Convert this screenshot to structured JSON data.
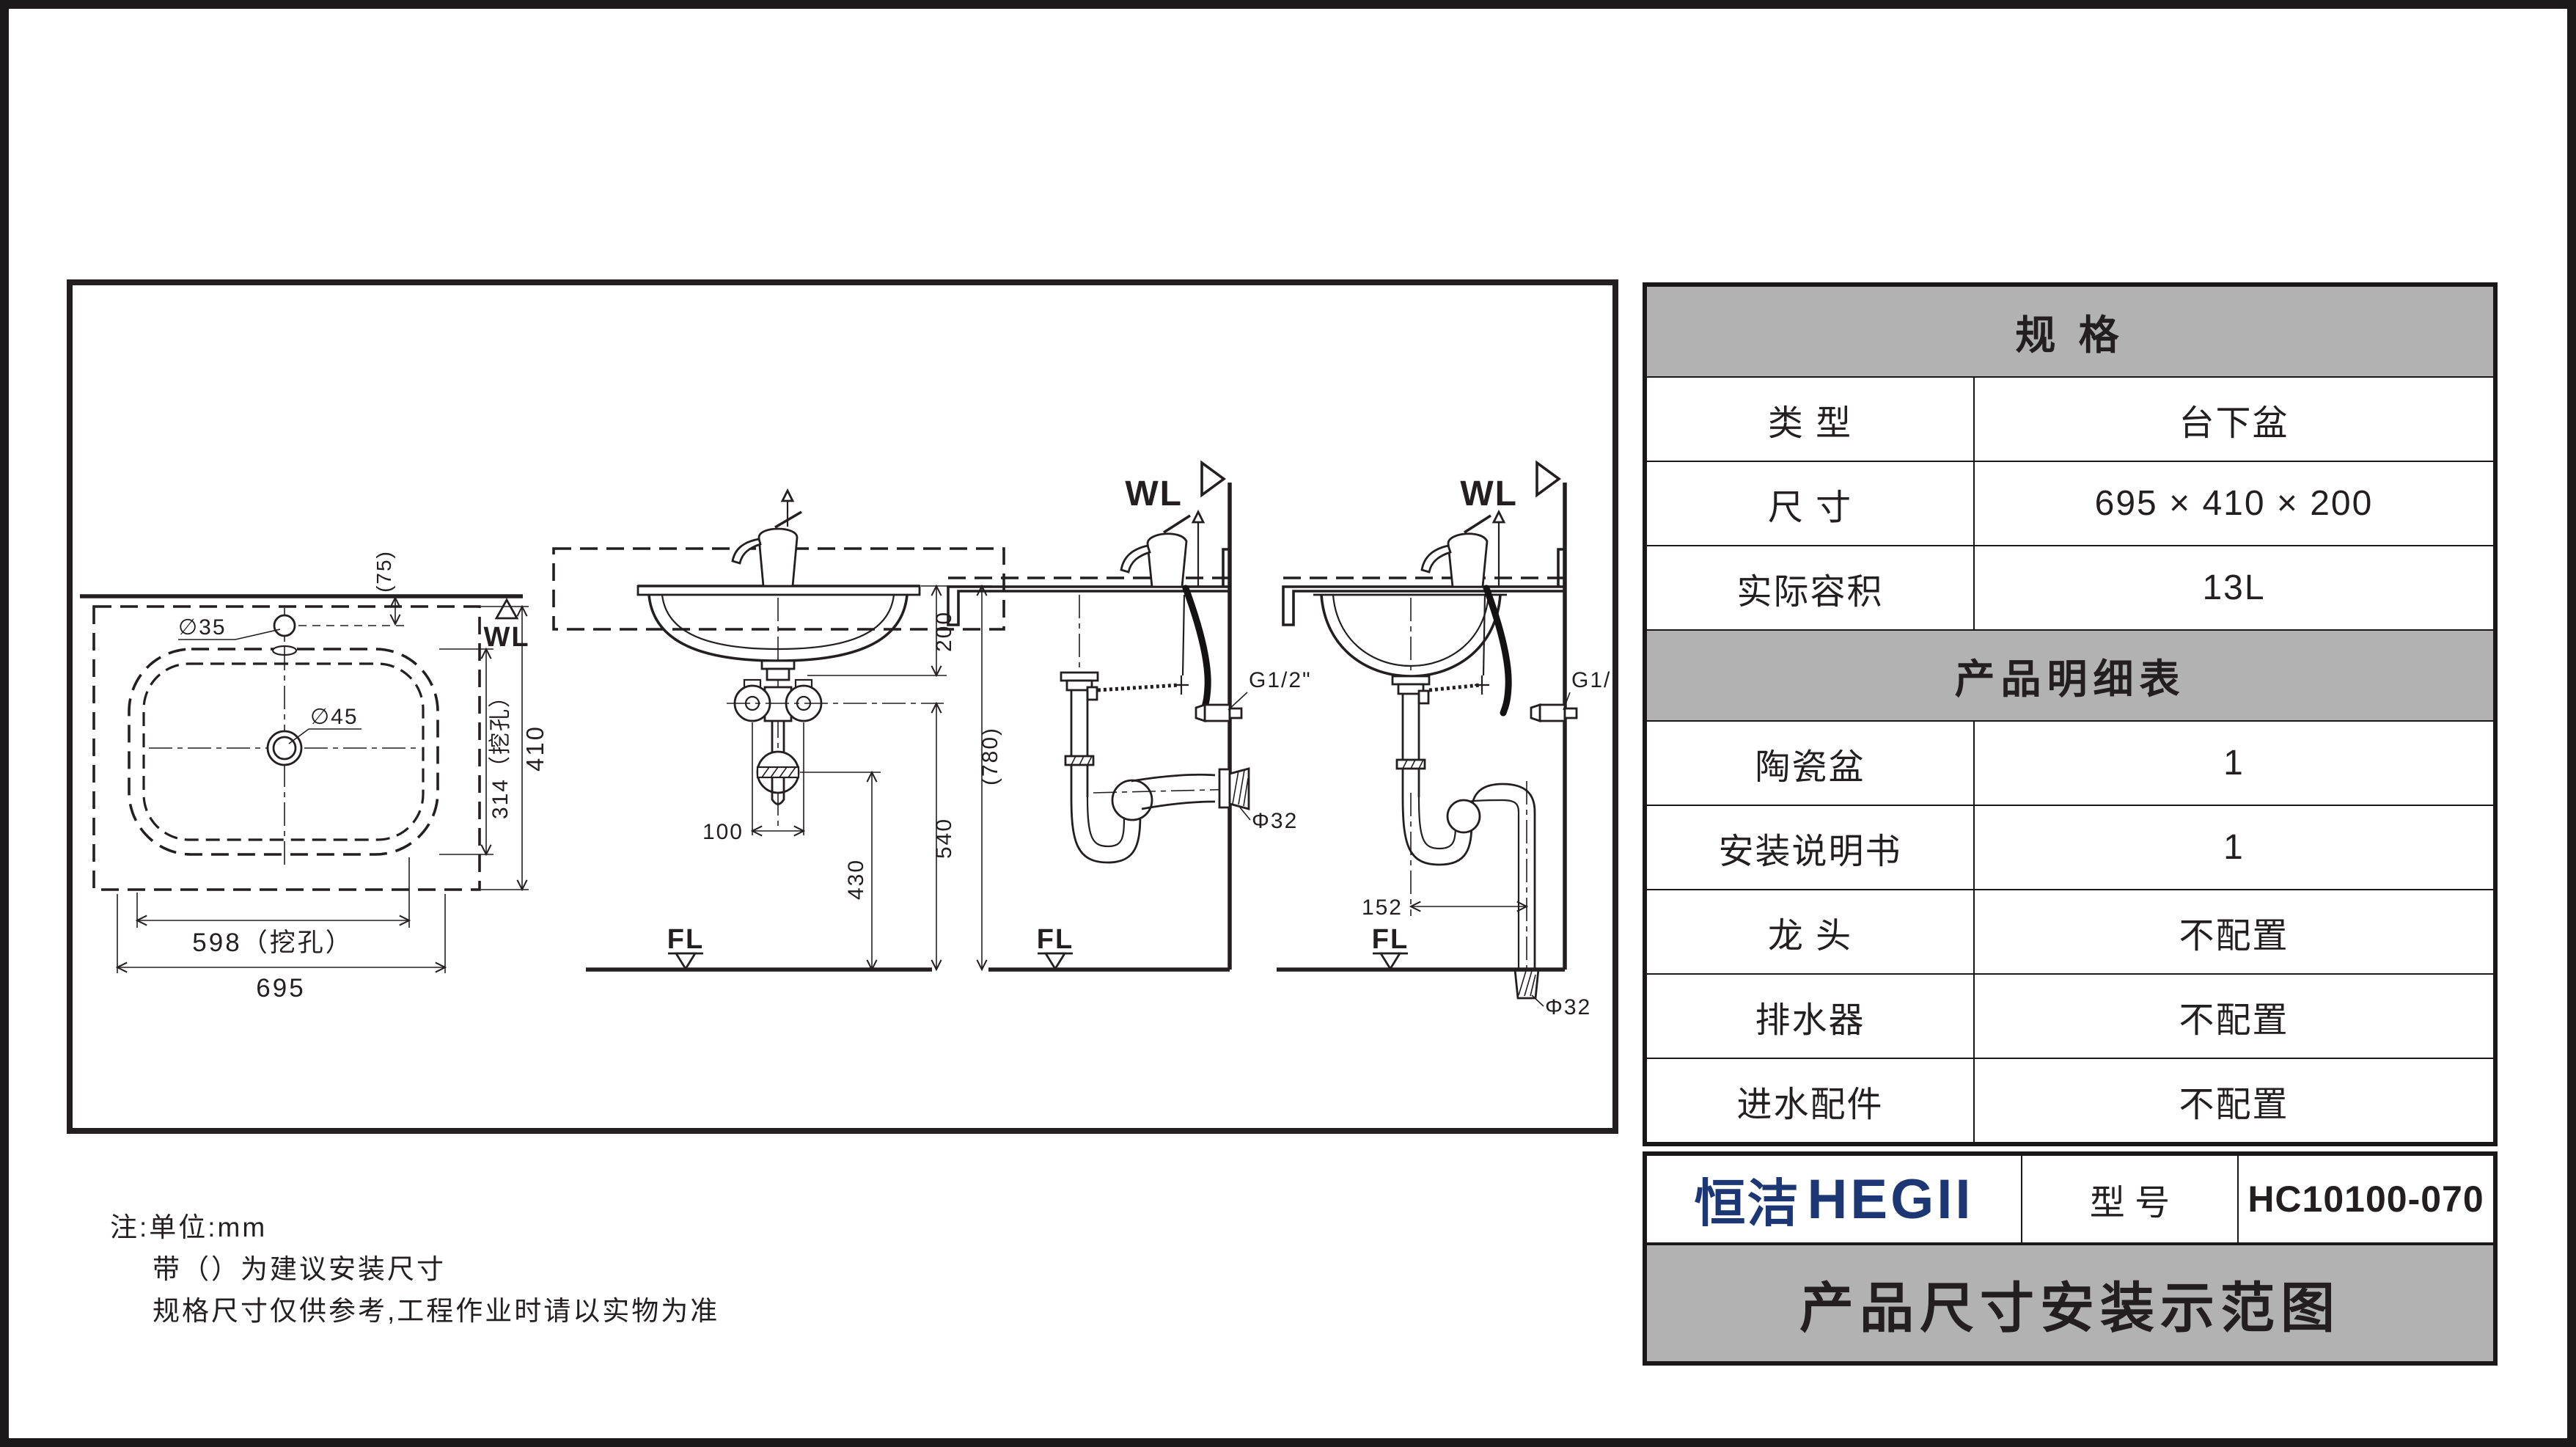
{
  "drawing": {
    "notes": {
      "line1": "注:单位:mm",
      "line2": "带（）为建议安装尺寸",
      "line3": "规格尺寸仅供参考,工程作业时请以实物为准"
    },
    "plan": {
      "water_line_label": "WL",
      "faucet_hole_dia": "∅35",
      "drain_hole_dia": "∅45",
      "faucet_hole_setback": "(75)",
      "cutout_depth": "314（挖孔）",
      "overall_depth": "410",
      "cutout_width": "598（挖孔）",
      "overall_width": "695"
    },
    "front": {
      "basin_height": "200",
      "suggested_counter_height": "(780)",
      "valve_height": "540",
      "drain_outlet_height": "430",
      "valve_spacing": "100",
      "floor_line_label": "FL"
    },
    "side_wall_drain": {
      "water_line_label": "WL",
      "inlet_thread": "G1/2\"",
      "drain_pipe_dia": "Φ32",
      "floor_line_label": "FL"
    },
    "side_floor_drain": {
      "water_line_label": "WL",
      "inlet_thread": "G1/2\"",
      "drain_pipe_dia": "Φ32",
      "trap_offset": "152",
      "floor_line_label": "FL"
    }
  },
  "spec_table": {
    "header": "规   格",
    "rows": [
      {
        "label": "类   型",
        "value": "台下盆"
      },
      {
        "label": "尺   寸",
        "value": "695 × 410 × 200"
      },
      {
        "label": "实际容积",
        "value": "13L"
      }
    ],
    "detail_header": "产品明细表",
    "detail_rows": [
      {
        "label": "陶瓷盆",
        "value": "1"
      },
      {
        "label": "安装说明书",
        "value": "1"
      },
      {
        "label": "龙   头",
        "value": "不配置"
      },
      {
        "label": "排水器",
        "value": "不配置"
      },
      {
        "label": "进水配件",
        "value": "不配置"
      }
    ]
  },
  "title_block": {
    "brand_cn": "恒洁",
    "brand_en": "HEGII",
    "model_label": "型   号",
    "model_value": "HC10100-070",
    "sheet_title": "产品尺寸安装示范图",
    "brand_color": "#1d3775",
    "header_gray": "#b2b2b2"
  }
}
